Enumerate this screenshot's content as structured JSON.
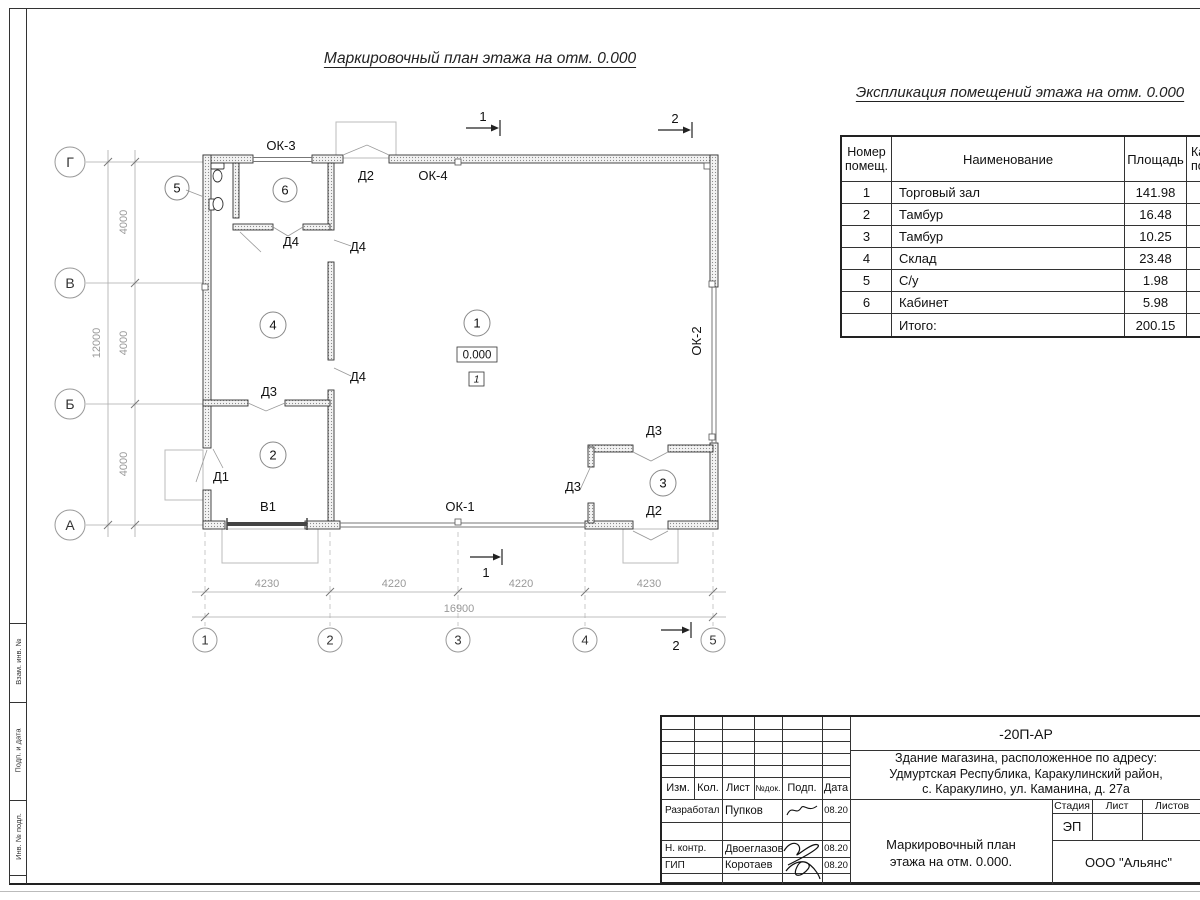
{
  "sheet": {
    "plan_title": "Маркировочный план этажа на отм. 0.000",
    "expl_title": "Экспликация помещений этажа на отм. 0.000"
  },
  "plan": {
    "axes_left": [
      "Г",
      "В",
      "Б",
      "А"
    ],
    "axes_bottom": [
      "1",
      "2",
      "3",
      "4",
      "5"
    ],
    "dims_left": [
      "4000",
      "4000",
      "4000"
    ],
    "dim_left_total": "12000",
    "dims_bottom": [
      "4230",
      "4220",
      "4220",
      "4230"
    ],
    "dim_bottom_total": "16900",
    "rooms": [
      "1",
      "2",
      "3",
      "4",
      "5",
      "6"
    ],
    "elevation": "0.000",
    "floor_mark": "1",
    "labels": {
      "ok1": "ОК-1",
      "ok2": "ОК-2",
      "ok3": "ОК-3",
      "ok4": "ОК-4",
      "d1": "Д1",
      "d2_top": "Д2",
      "d2_bot": "Д2",
      "d3_b": "Д3",
      "d3_r3_left": "Д3",
      "d3_r3_top": "Д3",
      "d4_a": "Д4",
      "d4_b": "Д4",
      "d4_c": "Д4",
      "v1": "В1"
    },
    "sections": {
      "top1": "1",
      "top2": "2",
      "bot1": "1",
      "bot2": "2"
    }
  },
  "explication": {
    "col_num_l1": "Номер",
    "col_num_l2": "помещ.",
    "col_name": "Наименование",
    "col_area": "Площадь",
    "col_cat_l1": "Ка",
    "col_cat_l2": "по",
    "rows": [
      {
        "num": "1",
        "name": "Торговый зал",
        "area": "141.98"
      },
      {
        "num": "2",
        "name": "Тамбур",
        "area": "16.48"
      },
      {
        "num": "3",
        "name": "Тамбур",
        "area": "10.25"
      },
      {
        "num": "4",
        "name": "Склад",
        "area": "23.48"
      },
      {
        "num": "5",
        "name": "С/у",
        "area": "1.98"
      },
      {
        "num": "6",
        "name": "Кабинет",
        "area": "5.98"
      }
    ],
    "total_label": "Итого:",
    "total_area": "200.15"
  },
  "titleblock": {
    "doc": "-20П-АР",
    "address1": "Здание магазина, расположенное по адресу:",
    "address2": "Удмуртская Республика, Каракулинский район,",
    "address3": "с. Каракулино, ул. Каманина, д. 27а",
    "h_izm": "Изм.",
    "h_kol": "Кол.",
    "h_list": "Лист",
    "h_ndok": "№док.",
    "h_podp": "Подп.",
    "h_data": "Дата",
    "r1_role": "Разработал",
    "r1_name": "Пупков",
    "r1_date": "08.20",
    "r2_role": "Н. контр.",
    "r2_name": "Двоеглазов",
    "r2_date": "08.20",
    "r3_role": "ГИП",
    "r3_name": "Коротаев",
    "r3_date": "08.20",
    "stage_h": "Стадия",
    "list_h": "Лист",
    "listov_h": "Листов",
    "stage": "ЭП",
    "title1": "Маркировочный план",
    "title2": "этажа на отм. 0.000.",
    "company": "ООО \"Альянс\""
  },
  "frame": {
    "v1": "Взам. инв. №",
    "v2": "Подп. и дата",
    "v3": "Инв. № подл."
  }
}
